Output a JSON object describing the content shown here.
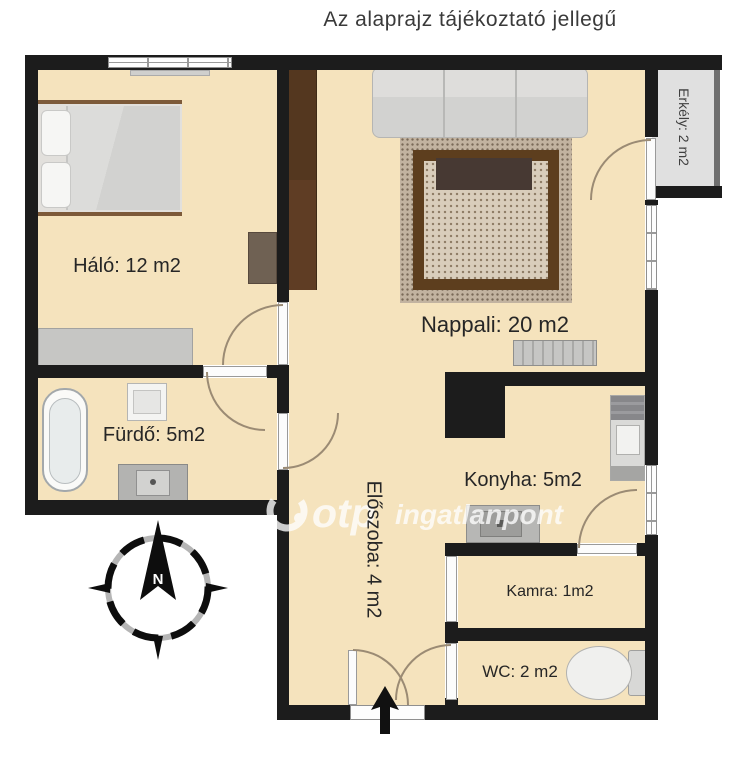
{
  "title": "Az alaprajz tájékoztató jellegű",
  "rooms": {
    "halo": {
      "label": "Háló: 12 m2"
    },
    "nappali": {
      "label": "Nappali: 20 m2"
    },
    "furdo": {
      "label": "Fürdő: 5m2"
    },
    "eloszoba": {
      "label": "Előszoba: 4 m2"
    },
    "konyha": {
      "label": "Konyha: 5m2"
    },
    "kamra": {
      "label": "Kamra: 1m2"
    },
    "wc": {
      "label": "WC: 2 m2"
    },
    "erkely": {
      "label": "Erkély: 2 m2"
    }
  },
  "compass": {
    "north_label": "N"
  },
  "watermark": {
    "logo": "otp",
    "brand": "ingatlanpont"
  },
  "colors": {
    "wall": "#1c1c1c",
    "floor": "#f5e3bd",
    "balcony_floor": "#e0e0e0",
    "rug_frame": "#5d3e1e",
    "wardrobe": "#54371f",
    "watermark": "#ffffff"
  }
}
